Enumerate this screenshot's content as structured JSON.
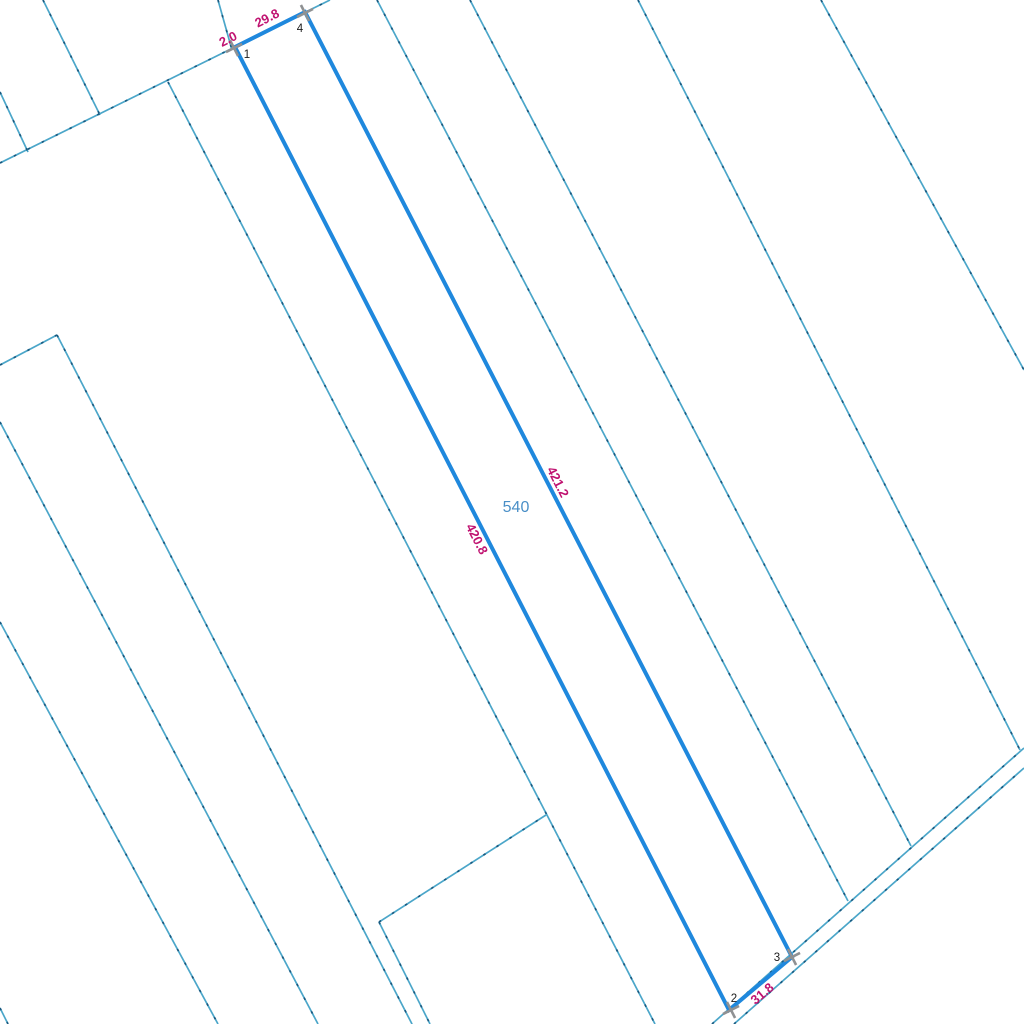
{
  "map": {
    "parcel_number": "540",
    "measurements": {
      "offset": "2.0",
      "top": "29.8",
      "right": "421.2",
      "left": "420.8",
      "bottom": "31.8"
    },
    "vertices": {
      "v1": "1",
      "v2": "2",
      "v3": "3",
      "v4": "4"
    },
    "colors": {
      "background": "#ffffff",
      "boundary_line": "#4ba6c9",
      "boundary_dot": "#1a5a80",
      "selected_parcel": "#1f88dd",
      "measurement_label": "#c01371",
      "parcel_number_label": "#4a8fc7",
      "vertex_marker": "#8f9193",
      "vertex_label": "#1b1b1b"
    }
  }
}
